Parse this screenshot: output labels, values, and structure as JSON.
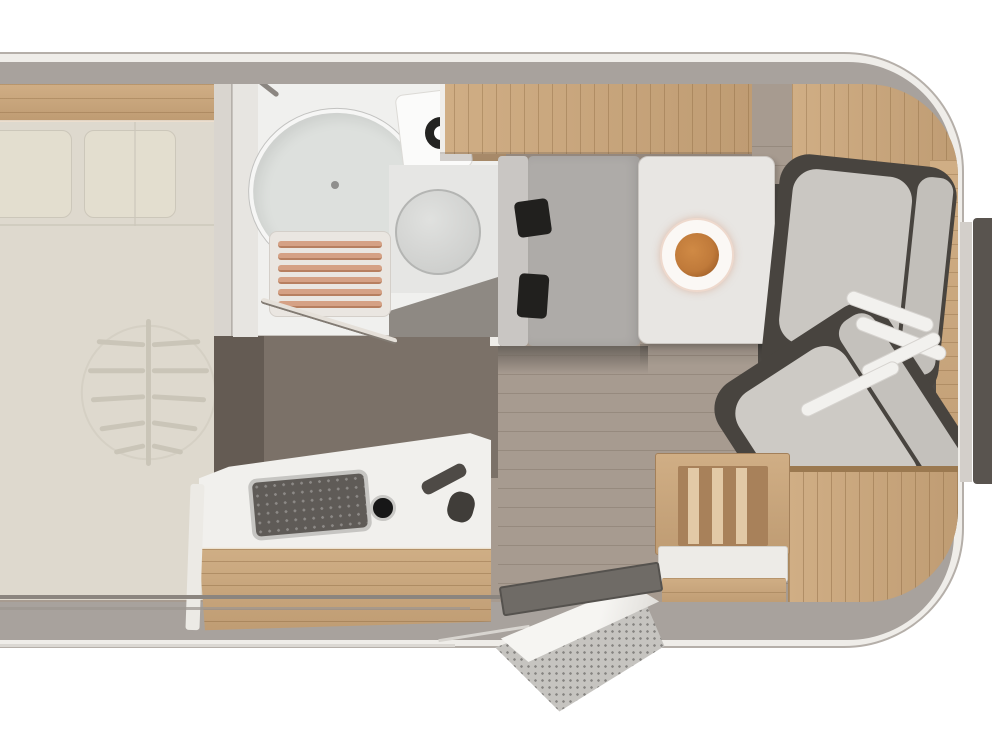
{
  "meta": {
    "type": "floor-plan",
    "subject": "Camper van interior, top-down floor plan",
    "orientation": "vehicle front with cab seats on the right, rear bed on the left"
  },
  "palette": {
    "white": "#ffffff",
    "rim": "#efede9",
    "outline": "#b5afa9",
    "wall": "#a8a29d",
    "bed": "#ded9ce",
    "bedSoft": "#e3decf",
    "bedLine": "#ccc7ba",
    "wood": "#d0ae85",
    "woodDeep": "#bf9c73",
    "woodDark": "#9b7950",
    "bath": "#f0f0ee",
    "bathWall": "#e7e5e1",
    "fixture": "#dde0dd",
    "fixtureEdge": "#f6f6f5",
    "toilet": "#d0d1cf",
    "slat": "#d5a185",
    "floor": "#a79b90",
    "corridor": "#7b7168",
    "corridorDeep": "#645b53",
    "charcoal": "#4d4944",
    "benchBack": "#c9c6c3",
    "bench": "#aeaba8",
    "black": "#21201e",
    "table": "#e8e6e3",
    "plate": "#fbf8f5",
    "plateRim": "#eed9cd",
    "food": "#c07a3a",
    "foodDeep": "#8e4f1c",
    "seatCushion": "#cac7c2",
    "seatBack": "#c2bfba",
    "seatFrame": "#48443f",
    "armrest": "#f2f1ee",
    "counter": "#f1f0ed",
    "sinkDark": "#5f5b57",
    "sinkRim": "#c6c5c2",
    "stepWhite": "#edebe7",
    "mat": "#c6c4c0",
    "thresh": "#6f6b66",
    "darkBand": "#59544f",
    "lightBand": "#d3cfca"
  },
  "rooms": {
    "bedroom": {
      "name": "rear bedroom",
      "features": [
        "double bed",
        "headboard wood shelf",
        "two pillows",
        "leaf-pattern bedspread"
      ]
    },
    "bathroom": {
      "name": "washroom",
      "features": [
        "oval washbasin",
        "faucet",
        "cup holder with ring",
        "toilet",
        "wooden shower grate",
        "wood shelf"
      ]
    },
    "kitchen": {
      "name": "kitchenette",
      "features": [
        "white counter",
        "dark inset sink",
        "control knob",
        "faucet",
        "wood drawer front"
      ]
    },
    "dinette": {
      "name": "front dinette",
      "features": [
        "bench seat",
        "table",
        "dinner plate with food",
        "front swivel seat",
        "rear swivel seat",
        "white armrests"
      ]
    },
    "storage": {
      "name": "cabinetry",
      "features": [
        "overhead cabinet strip",
        "front corner cabinet",
        "side wood column",
        "curved wardrobe",
        "entry cabinet with slats",
        "entry step seat",
        "step drawer"
      ]
    },
    "entry": {
      "name": "entrance",
      "features": [
        "door opening",
        "open door leaf",
        "dark threshold",
        "speckled step mat"
      ]
    }
  }
}
